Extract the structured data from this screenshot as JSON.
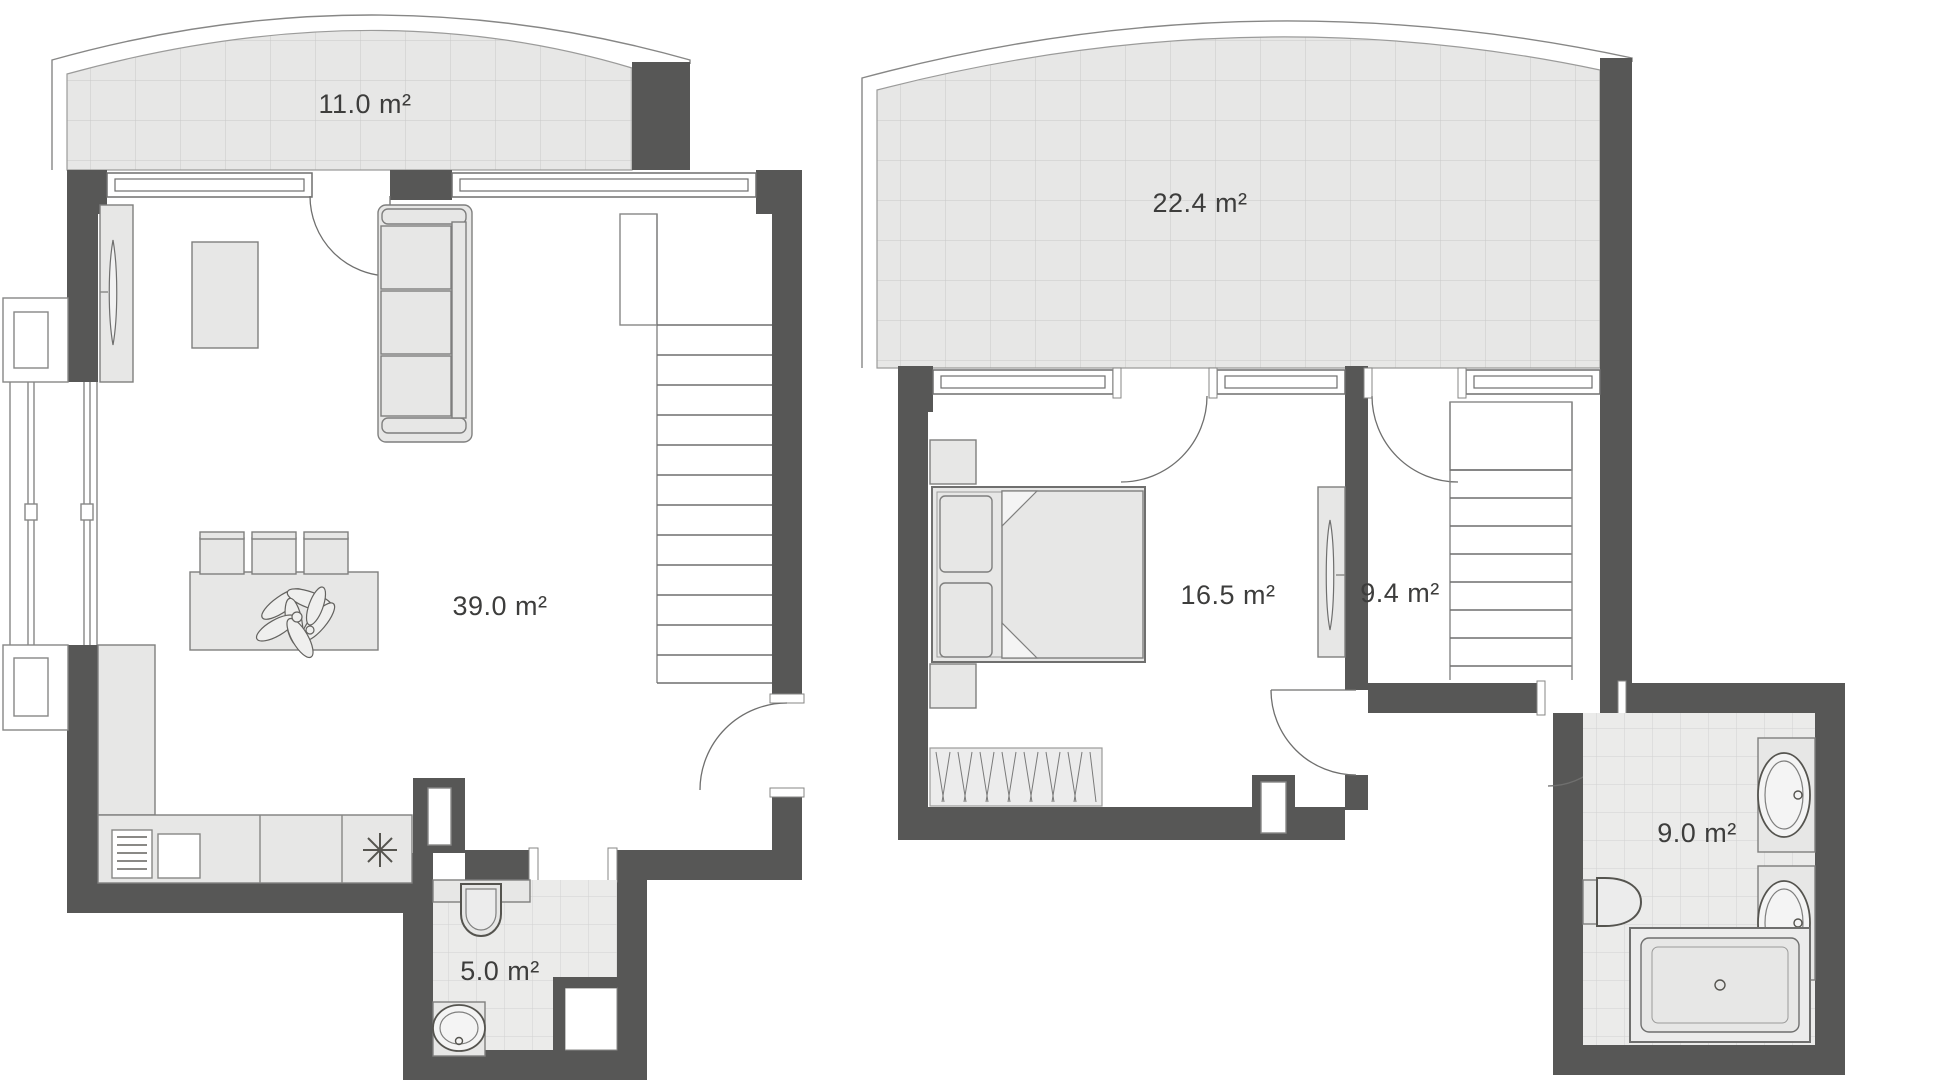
{
  "floor_plan": {
    "units": "m²",
    "lower_floor": {
      "terrace": {
        "name": "terrace",
        "area_label": "11.0 m²"
      },
      "living_room_kitchen": {
        "name": "living room / kitchen",
        "area_label": "39.0 m²"
      },
      "bathroom": {
        "name": "bathroom",
        "area_label": "5.0 m²"
      },
      "furniture": [
        "tv-panel",
        "coffee-table",
        "sofa",
        "dining-table",
        "chairs",
        "plant",
        "kitchen-counter",
        "kitchen-sink",
        "stove-burner",
        "staircase",
        "toilet",
        "washbasin"
      ]
    },
    "upper_floor": {
      "terrace": {
        "name": "terrace",
        "area_label": "22.4 m²"
      },
      "bedroom": {
        "name": "bedroom",
        "area_label": "16.5 m²"
      },
      "hallway": {
        "name": "hallway",
        "area_label": "9.4 m²"
      },
      "bathroom": {
        "name": "bathroom",
        "area_label": "9.0 m²"
      },
      "furniture": [
        "double-bed",
        "pillows",
        "nightstands",
        "rug",
        "tv-panel",
        "staircase",
        "two-washbasins",
        "toilet",
        "bathtub"
      ]
    },
    "colors": {
      "background": "#ffffff",
      "wall": "#575756",
      "furniture_fill": "#e7e7e6",
      "terrace_grid_line": "#c9c9c8",
      "tile_line": "#d2d2d1",
      "outline": "#878786",
      "label_text": "#3d3d3c"
    }
  }
}
